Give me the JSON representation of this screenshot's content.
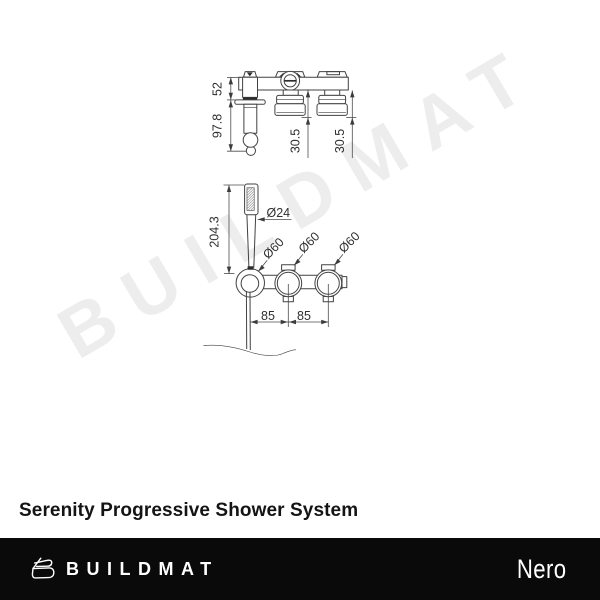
{
  "watermark_text": "BUILDMAT",
  "product": {
    "title": "Serenity Progressive Shower System"
  },
  "footer": {
    "brand_text": "BUILDMAT",
    "partner_brand": "Nero"
  },
  "colors": {
    "footer_bg": "#0a0a0a",
    "watermark": "#ededed",
    "drawing_line": "#424242",
    "title_text": "#141414"
  },
  "drawing": {
    "side_view_dims": {
      "bar_height": "52",
      "handshower_drop": "97.8",
      "trim_depth_a": "30.5",
      "trim_depth_b": "30.5"
    },
    "front_view_dims": {
      "handshower_height": "204.3",
      "handpiece_dia": "Ø24",
      "rosette_dia_1": "Ø60",
      "rosette_dia_2": "Ø60",
      "rosette_dia_3": "Ø60",
      "centres_a": "85",
      "centres_b": "85"
    }
  }
}
